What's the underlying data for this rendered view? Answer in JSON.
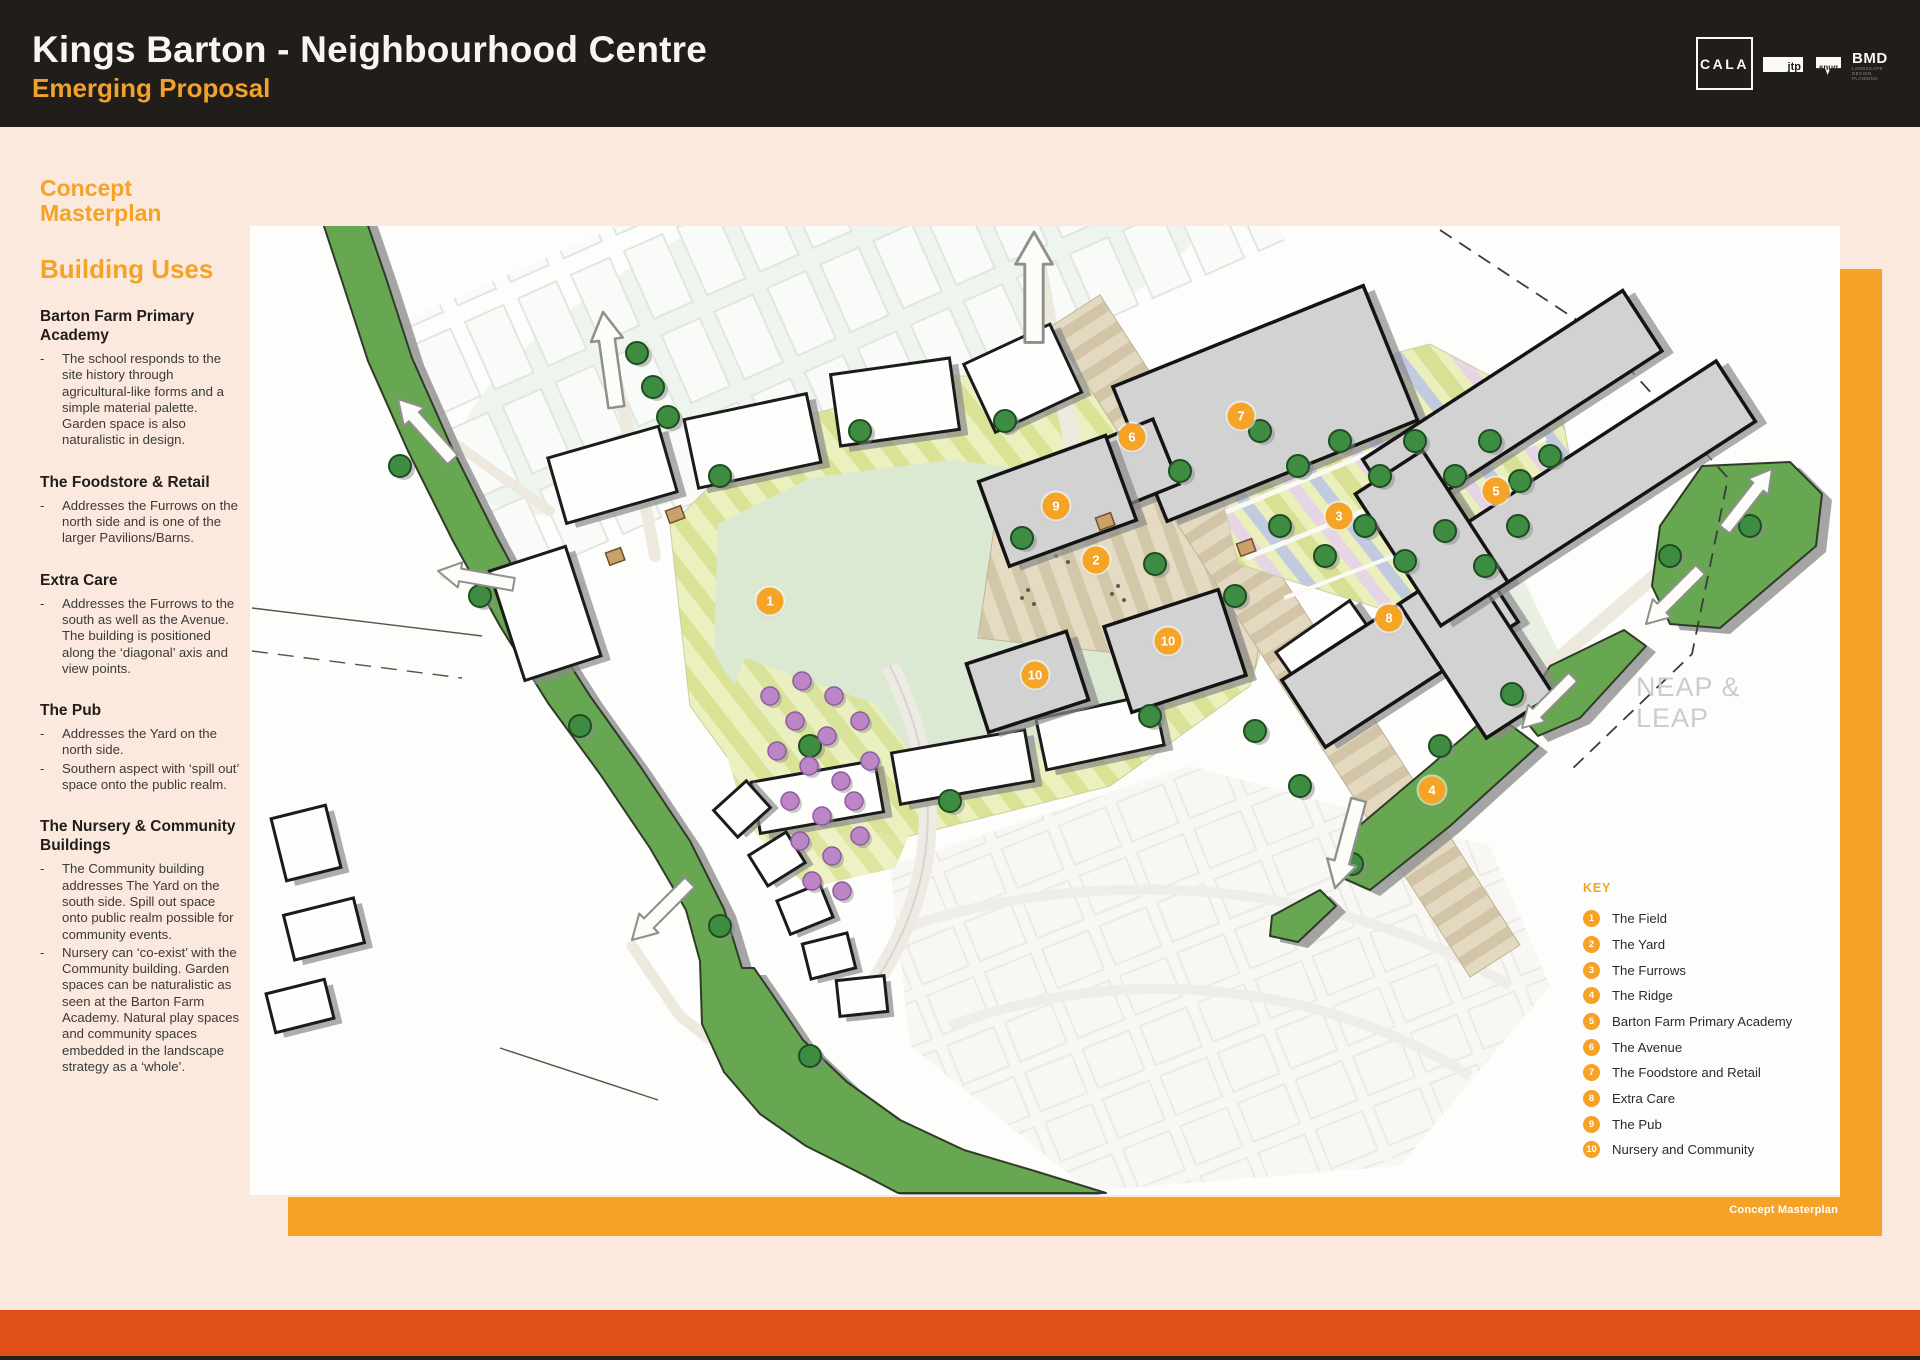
{
  "header": {
    "title": "Kings Barton - Neighbourhood Centre",
    "subtitle": "Emerging Proposal",
    "logos": {
      "cala": "CALA",
      "jtp": "jtp",
      "snug": "snug",
      "bmd": "BMD",
      "bmd_sub": [
        "LANDSCAPE",
        "DESIGN",
        "PLANNING"
      ]
    }
  },
  "sidebar": {
    "page_heading": "Concept Masterplan",
    "section_heading": "Building Uses",
    "sections": [
      {
        "title": "Barton Farm Primary Academy",
        "bullets": [
          "The school responds to the site history through agricultural-like forms and a simple material palette. Garden space is also naturalistic in design."
        ]
      },
      {
        "title": "The Foodstore & Retail",
        "bullets": [
          "Addresses the Furrows on the north side and is one of the larger Pavilions/Barns."
        ]
      },
      {
        "title": "Extra Care",
        "bullets": [
          "Addresses the Furrows to the south as well as the Avenue. The building is positioned along the ‘diagonal’ axis and view points."
        ]
      },
      {
        "title": "The Pub",
        "bullets": [
          "Addresses the Yard on the north side.",
          "Southern aspect with ‘spill out’ space onto the public realm."
        ]
      },
      {
        "title": "The Nursery & Community Buildings",
        "bullets": [
          "The Community building addresses The Yard on the south side. Spill out space onto public realm possible for community events.",
          "Nursery can ‘co-exist’ with the Community building. Garden spaces can be naturalistic as seen at the Barton Farm Academy. Natural play spaces and community spaces embedded in the landscape strategy as a ‘whole’."
        ]
      }
    ]
  },
  "map": {
    "neap_leap": "NEAP & LEAP",
    "caption": "Concept Masterplan",
    "key": {
      "title": "KEY",
      "items": [
        {
          "num": "1",
          "label": "The Field"
        },
        {
          "num": "2",
          "label": "The Yard"
        },
        {
          "num": "3",
          "label": "The Furrows"
        },
        {
          "num": "4",
          "label": "The Ridge"
        },
        {
          "num": "5",
          "label": "Barton Farm Primary Academy"
        },
        {
          "num": "6",
          "label": "The Avenue"
        },
        {
          "num": "7",
          "label": "The Foodstore and Retail"
        },
        {
          "num": "8",
          "label": "Extra Care"
        },
        {
          "num": "9",
          "label": "The Pub"
        },
        {
          "num": "10",
          "label": "Nursery and Community"
        }
      ]
    },
    "markers": [
      {
        "num": "1",
        "x": 520,
        "y": 375
      },
      {
        "num": "2",
        "x": 846,
        "y": 334
      },
      {
        "num": "3",
        "x": 1089,
        "y": 290
      },
      {
        "num": "4",
        "x": 1182,
        "y": 564
      },
      {
        "num": "5",
        "x": 1246,
        "y": 265
      },
      {
        "num": "6",
        "x": 882,
        "y": 211
      },
      {
        "num": "7",
        "x": 991,
        "y": 190
      },
      {
        "num": "8",
        "x": 1139,
        "y": 392
      },
      {
        "num": "9",
        "x": 806,
        "y": 280
      },
      {
        "num": "10",
        "x": 918,
        "y": 415
      },
      {
        "num": "10",
        "x": 785,
        "y": 449
      }
    ]
  },
  "colors": {
    "accent_orange": "#F5A226",
    "footer_red": "#E2501A",
    "header_bg": "#201D1A",
    "page_bg": "#FBE9DD",
    "band_green": "#68A751"
  }
}
